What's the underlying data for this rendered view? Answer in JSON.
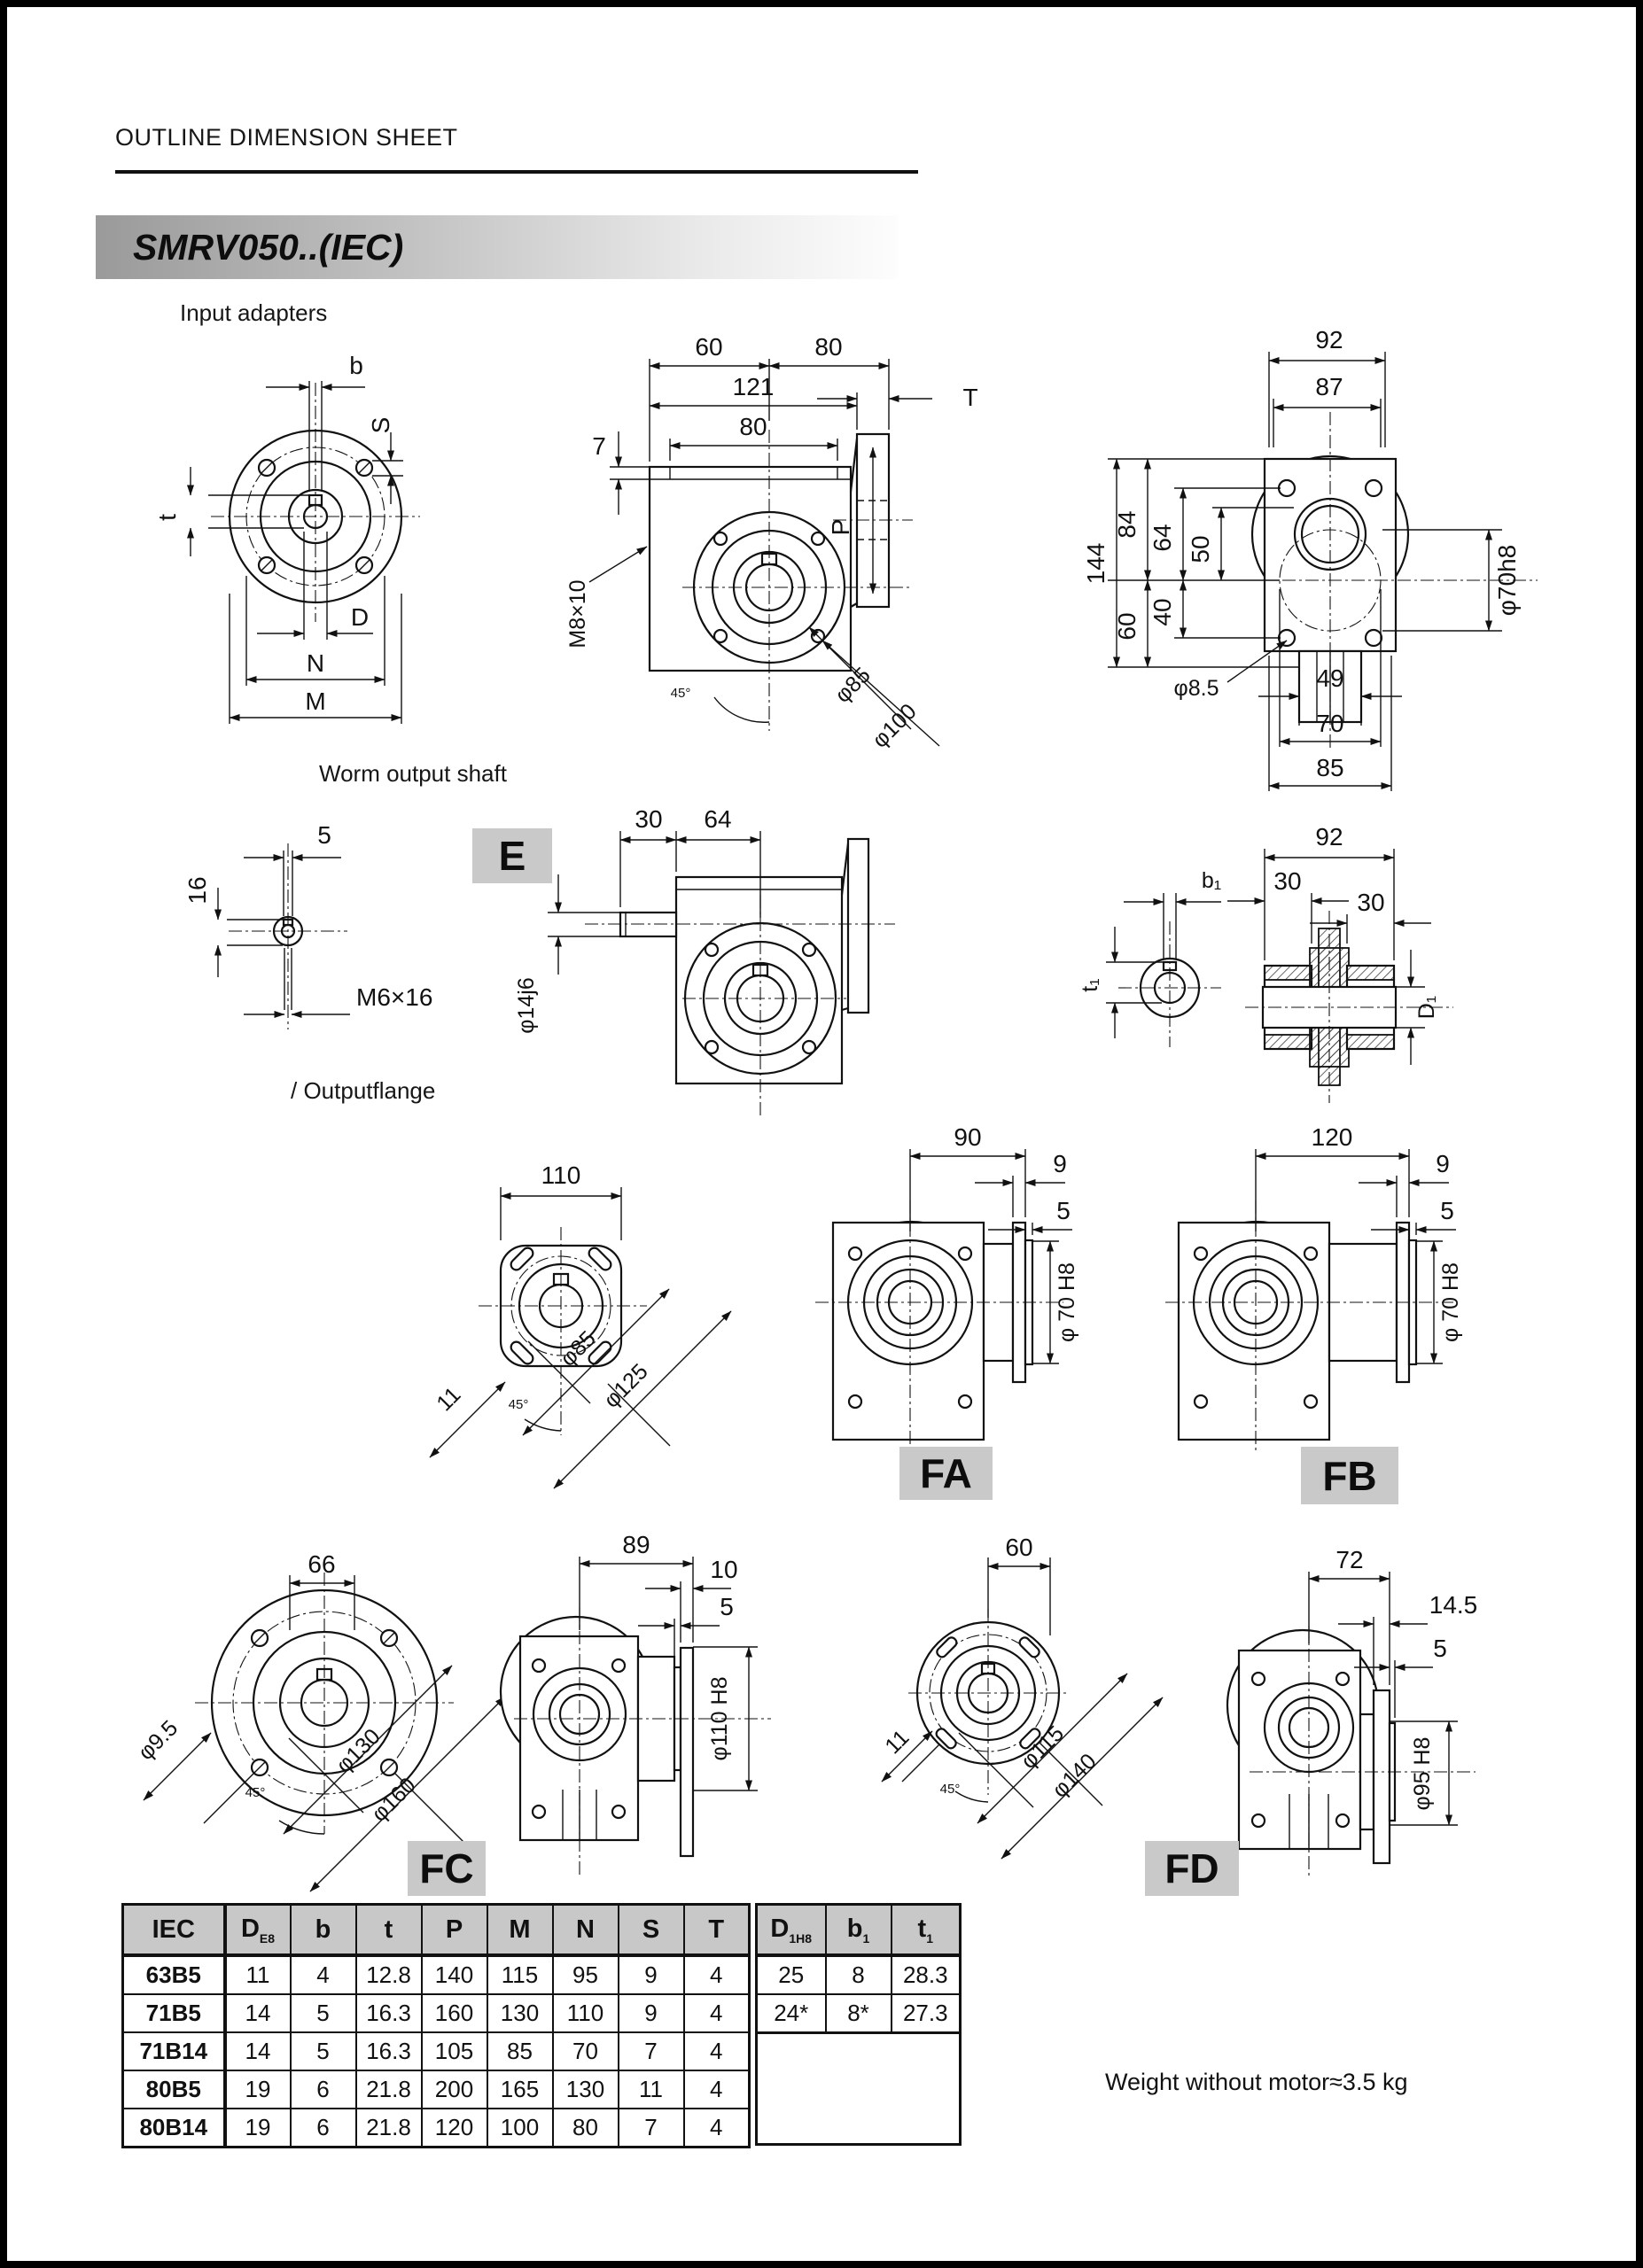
{
  "page": {
    "header": "OUTLINE DIMENSION SHEET",
    "model": "SMRV050..(IEC)",
    "weight_note": "Weight without motor≈3.5 kg"
  },
  "sections": {
    "input_adapters": "Input adapters",
    "worm_output_shaft": "Worm output shaft",
    "output_flange": "/ Outputflange"
  },
  "badges": {
    "e": "E",
    "fa": "FA",
    "fb": "FB",
    "fc": "FC",
    "fd": "FD"
  },
  "dims": {
    "af_b": "b",
    "af_s": "S",
    "af_t": "t",
    "af_d": "D",
    "af_n": "N",
    "af_m": "M",
    "as_60": "60",
    "as_80": "80",
    "as_121": "121",
    "as_80i": "80",
    "as_7": "7",
    "as_t": "T",
    "as_p": "P",
    "as_m8": "M8×10",
    "as_phi85": "φ85",
    "as_phi100": "φ100",
    "as_45": "45°",
    "ar_92": "92",
    "ar_87": "87",
    "ar_144": "144",
    "ar_84": "84",
    "ar_64": "64",
    "ar_50": "50",
    "ar_40": "40",
    "ar_60": "60",
    "ar_phi70h8": "φ70h8",
    "ar_phi85": "φ8.5",
    "ar_49": "49",
    "ar_70": "70",
    "ar_85": "85",
    "ws_5": "5",
    "ws_16": "16",
    "ws_m6": "M6×16",
    "wv_30": "30",
    "wv_64": "64",
    "wv_phi14": "φ14j6",
    "cp_b1": "b₁",
    "cp_t1": "t₁",
    "cp_92": "92",
    "cp_30a": "30",
    "cp_30b": "30",
    "cp_d1": "D₁",
    "of_110": "110",
    "of_11": "11",
    "of_phi85": "φ85",
    "of_phi125": "φ125",
    "of_45": "45°",
    "fa_90": "90",
    "fa_9": "9",
    "fa_5": "5",
    "fa_phi70": "φ 70 H8",
    "fb_120": "120",
    "fb_9": "9",
    "fb_5": "5",
    "fb_phi70": "φ 70 H8",
    "fcf_66": "66",
    "fcf_phi95": "φ9.5",
    "fcf_phi130": "φ130",
    "fcf_phi160": "φ160",
    "fcf_45": "45°",
    "fcs_89": "89",
    "fcs_10": "10",
    "fcs_5": "5",
    "fcs_phi110": "φ110 H8",
    "fdf_60": "60",
    "fdf_11": "11",
    "fdf_phi115": "φ115",
    "fdf_phi140": "φ140",
    "fdf_45": "45°",
    "fds_72": "72",
    "fds_145": "14.5",
    "fds_5": "5",
    "fds_phi95": "φ95 H8"
  },
  "table": {
    "left_headers": [
      {
        "main": "IEC",
        "sub": ""
      },
      {
        "main": "D",
        "sub": "E8"
      },
      {
        "main": "b",
        "sub": ""
      },
      {
        "main": "t",
        "sub": ""
      },
      {
        "main": "P",
        "sub": ""
      },
      {
        "main": "M",
        "sub": ""
      },
      {
        "main": "N",
        "sub": ""
      },
      {
        "main": "S",
        "sub": ""
      },
      {
        "main": "T",
        "sub": ""
      }
    ],
    "right_headers": [
      {
        "main": "D",
        "sub": "1H8"
      },
      {
        "main": "b",
        "sub": "1"
      },
      {
        "main": "t",
        "sub": "1"
      }
    ],
    "rows": [
      {
        "iec": "63B5",
        "v": [
          "11",
          "4",
          "12.8",
          "140",
          "115",
          "95",
          "9",
          "4"
        ]
      },
      {
        "iec": "71B5",
        "v": [
          "14",
          "5",
          "16.3",
          "160",
          "130",
          "110",
          "9",
          "4"
        ]
      },
      {
        "iec": "71B14",
        "v": [
          "14",
          "5",
          "16.3",
          "105",
          "85",
          "70",
          "7",
          "4"
        ]
      },
      {
        "iec": "80B5",
        "v": [
          "19",
          "6",
          "21.8",
          "200",
          "165",
          "130",
          "11",
          "4"
        ]
      },
      {
        "iec": "80B14",
        "v": [
          "19",
          "6",
          "21.8",
          "120",
          "100",
          "80",
          "7",
          "4"
        ]
      }
    ],
    "right_rows": [
      [
        "25",
        "8",
        "28.3"
      ],
      [
        "24*",
        "8*",
        "27.3"
      ]
    ]
  }
}
